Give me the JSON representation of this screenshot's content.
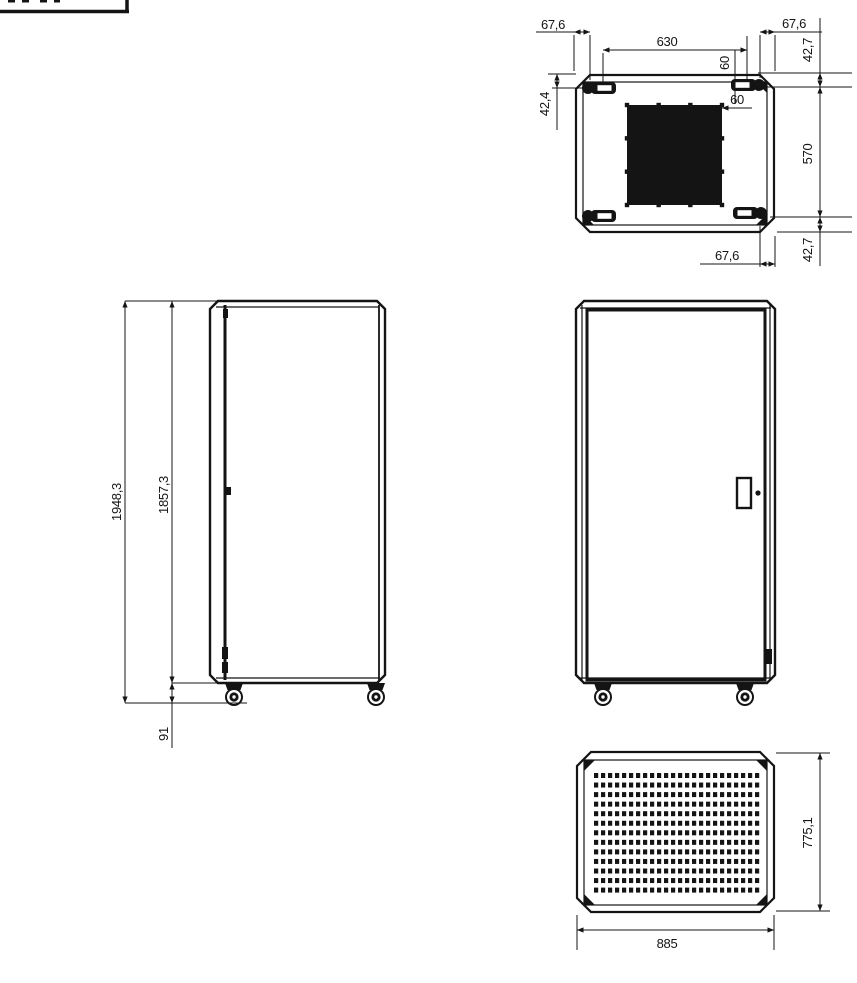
{
  "page": {
    "background": "#ffffff",
    "ink": "#141414"
  },
  "views": {
    "bottom": {
      "dims": {
        "left_offset": "67,6",
        "caster_span_width": "630",
        "right_offset": "67,6",
        "top_right_inset": "42,7",
        "cutout_offset_v": "60",
        "cutout_offset_h": "60",
        "left_inset": "42,4",
        "caster_span_depth": "570",
        "bottom_offset": "67,6",
        "bottom_right_inset": "42,7"
      },
      "cutout_dots_per_edge": 4
    },
    "side": {
      "dims": {
        "overall_height": "1948,3",
        "body_height": "1857,3",
        "caster_height": "91"
      }
    },
    "front": {},
    "top": {
      "dims": {
        "depth": "775,1",
        "width": "885"
      },
      "perforation": {
        "rows": 13,
        "cols": 24
      }
    }
  }
}
